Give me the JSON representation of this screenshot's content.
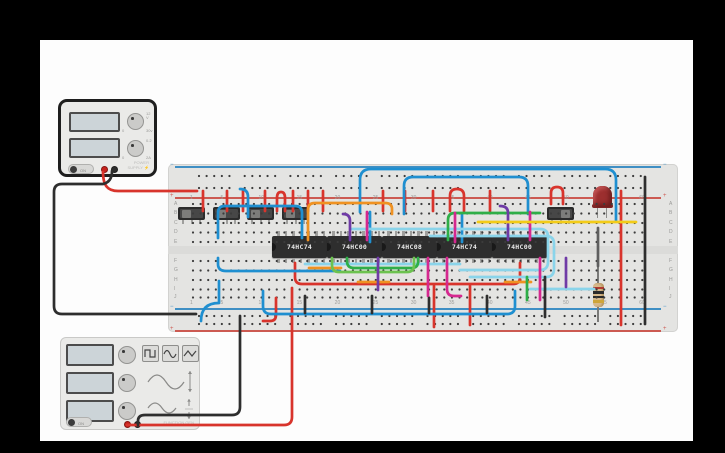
{
  "app": {
    "background": "#000000",
    "canvas_color": "#fdfdfd"
  },
  "power_supply": {
    "name": "power-supply",
    "displays": [
      "",
      ""
    ],
    "knobs": [
      {
        "name": "voltage-knob",
        "value": "12 V",
        "min": "0",
        "max": "30v"
      },
      {
        "name": "current-knob",
        "value": "0.2",
        "min": "0",
        "max": "2A"
      }
    ],
    "toggle_label": "ON",
    "caption": "POWER SUPPLY",
    "bolt": "⚡"
  },
  "function_generator": {
    "name": "function-generator",
    "displays": [
      "",
      "",
      ""
    ],
    "wave_buttons": [
      "square",
      "sine",
      "triangle"
    ],
    "toggle_label": "ON",
    "caption": "FUNCTION GEN"
  },
  "breadboard": {
    "column_numbers": [
      "1",
      "5",
      "10",
      "15",
      "20",
      "25",
      "30",
      "35",
      "40",
      "45",
      "50",
      "55",
      "60"
    ],
    "row_letters_top": [
      "A",
      "B",
      "C",
      "D",
      "E"
    ],
    "row_letters_bottom": [
      "F",
      "G",
      "H",
      "I",
      "J"
    ],
    "rail_minus": "−",
    "rail_plus": "+",
    "rail_blue": "#3f8fc4",
    "rail_red": "#cc5a52"
  },
  "ics": [
    {
      "label": "74HC74"
    },
    {
      "label": "74HC00"
    },
    {
      "label": "74HC08"
    },
    {
      "label": "74HC74"
    },
    {
      "label": "74HC00"
    }
  ],
  "switches": [
    {
      "x": 178,
      "knob": "left"
    },
    {
      "x": 213,
      "knob": "left"
    },
    {
      "x": 247,
      "knob": "left"
    },
    {
      "x": 282,
      "knob": "left"
    },
    {
      "x": 547,
      "knob": "right"
    }
  ],
  "led": {
    "color": "#9c2f2f"
  },
  "resistor": {
    "bands": [
      "red",
      "black",
      "black",
      "gold"
    ],
    "band_colors": {
      "red": "#b03a30",
      "black": "#2b2b2b",
      "gold": "#cda53a"
    }
  },
  "wire_colors": {
    "red": "#d8342c",
    "blue": "#1f8fd0",
    "cyan": "#8ad4ea",
    "orange": "#ef9222",
    "green": "#2fae48",
    "lightgreen": "#6cc24f",
    "purple": "#6f3ba6",
    "magenta": "#d5288f",
    "yellow": "#f2cb18",
    "black": "#2e2e2e",
    "gray": "#5f5f5f"
  },
  "wires": [
    {
      "color": "red",
      "d": "M103,172 C103,186 108,191 118,191 L197,191"
    },
    {
      "color": "red",
      "d": "M203,191 L203,211"
    },
    {
      "color": "red",
      "d": "M227,191 L227,211"
    },
    {
      "color": "red",
      "d": "M243,191 L243,211"
    },
    {
      "color": "red",
      "d": "M265,191 L265,211"
    },
    {
      "color": "red",
      "d": "M293,191 L293,211"
    },
    {
      "color": "red",
      "d": "M308,191 L308,211"
    },
    {
      "color": "red",
      "d": "M323,191 L323,211"
    },
    {
      "color": "red",
      "d": "M383,191 L383,211"
    },
    {
      "color": "red",
      "d": "M405,191 L405,211"
    },
    {
      "color": "red",
      "d": "M433,191 L433,211"
    },
    {
      "color": "red",
      "d": "M490,191 L490,211"
    },
    {
      "color": "red",
      "d": "M277,211 L277,198 Q277,192 281,192 Q285,192 285,198 L285,211"
    },
    {
      "color": "red",
      "d": "M450,211 L450,196 Q450,189 457,189 Q464,189 464,196 L464,211"
    },
    {
      "color": "red",
      "d": "M551,204 L551,193 Q551,187 557,187 Q563,187 563,193 L563,204"
    },
    {
      "color": "red",
      "d": "M621,191 L621,325"
    },
    {
      "color": "red",
      "d": "M127,425 L284,425 Q292,425 292,417 L292,288"
    },
    {
      "color": "red",
      "d": "M295,263 L295,277 Q295,284 302,284 L513,284 Q520,284 520,277 L520,263"
    },
    {
      "color": "red",
      "d": "M276,298 L276,315 Q276,321 270,321 L263,321"
    },
    {
      "color": "red",
      "d": "M434,286 L434,327"
    },
    {
      "color": "red",
      "d": "M470,286 L470,325"
    },
    {
      "color": "blue",
      "d": "M360,212 L360,180 Q360,169 371,169 L605,169 Q616,169 616,180 L616,221"
    },
    {
      "color": "blue",
      "d": "M404,214 L404,186 Q404,177 413,177 L519,177 Q528,177 528,186 L528,214"
    },
    {
      "color": "blue",
      "d": "M218,238 L218,213 Q218,206 225,206 L295,206 Q302,206 302,213 L302,238"
    },
    {
      "color": "blue",
      "d": "M240,189 Q248,189 248,197 L248,217"
    },
    {
      "color": "blue",
      "d": "M370,212 L370,242"
    },
    {
      "color": "blue",
      "d": "M462,214 L462,242"
    },
    {
      "color": "blue",
      "d": "M263,291 L263,306 Q263,314 271,314 L507,314 Q515,314 515,306 L515,291"
    },
    {
      "color": "blue",
      "d": "M218,258 L218,264 Q218,271 226,271 L340,271"
    },
    {
      "color": "blue",
      "d": "M201,321 Q201,303 219,303 L219,281"
    },
    {
      "color": "cyan",
      "d": "M352,229 L540,229 Q548,229 548,237 L548,262 Q548,270 540,270 L460,270"
    },
    {
      "color": "cyan",
      "d": "M430,236 L546,236 Q554,236 554,244 L554,269 Q554,277 546,277 L470,277"
    },
    {
      "color": "cyan",
      "d": "M305,264 L460,264"
    },
    {
      "color": "cyan",
      "d": "M530,289 L594,289"
    },
    {
      "color": "orange",
      "d": "M308,240 L308,210 Q308,203 315,203 L385,203 Q392,203 392,209 L392,214"
    },
    {
      "color": "orange",
      "d": "M309,268 L341,268"
    },
    {
      "color": "orange",
      "d": "M505,282 L531,282"
    },
    {
      "color": "orange",
      "d": "M358,282 L389,282"
    },
    {
      "color": "green",
      "d": "M448,240 L448,220 Q448,213 455,213 L540,213"
    },
    {
      "color": "green",
      "d": "M347,258 L347,261 Q347,268 354,268 L411,268 Q418,268 418,262 L418,258"
    },
    {
      "color": "lightgreen",
      "d": "M332,258 L332,265 Q332,272 339,272 L407,272 Q414,272 414,265 L414,258"
    },
    {
      "color": "green",
      "d": "M527,277 L527,300"
    },
    {
      "color": "purple",
      "d": "M343,214 Q350,214 350,221 L350,240"
    },
    {
      "color": "purple",
      "d": "M378,258 L378,290"
    },
    {
      "color": "purple",
      "d": "M566,258 L566,287"
    },
    {
      "color": "purple",
      "d": "M500,206 Q508,206 508,213 L508,240"
    },
    {
      "color": "magenta",
      "d": "M367,212 L367,240"
    },
    {
      "color": "magenta",
      "d": "M455,213 L455,242"
    },
    {
      "color": "magenta",
      "d": "M428,258 L428,296"
    },
    {
      "color": "magenta",
      "d": "M447,258 L447,289 Q447,296 454,296 L461,296"
    },
    {
      "color": "magenta",
      "d": "M530,212 L530,240"
    },
    {
      "color": "magenta",
      "d": "M540,258 L540,300"
    },
    {
      "color": "yellow",
      "d": "M478,222 L636,222"
    },
    {
      "color": "gray",
      "d": "M598,228 L598,266"
    },
    {
      "color": "black",
      "d": "M305,296 L305,313"
    },
    {
      "color": "black",
      "d": "M372,296 L372,313"
    },
    {
      "color": "black",
      "d": "M429,298 L429,313"
    },
    {
      "color": "black",
      "d": "M487,296 L487,313"
    },
    {
      "color": "black",
      "d": "M545,277 L545,317"
    },
    {
      "color": "black",
      "d": "M645,177 L645,324"
    },
    {
      "color": "black",
      "d": "M112,171 Q112,182 103,184 L62,184 Q54,184 54,192 L54,306 Q54,314 62,314 L196,314"
    },
    {
      "color": "black",
      "d": "M240,316 L240,407 Q240,415 232,415 L145,415 Q138,415 138,421 L138,425"
    }
  ]
}
